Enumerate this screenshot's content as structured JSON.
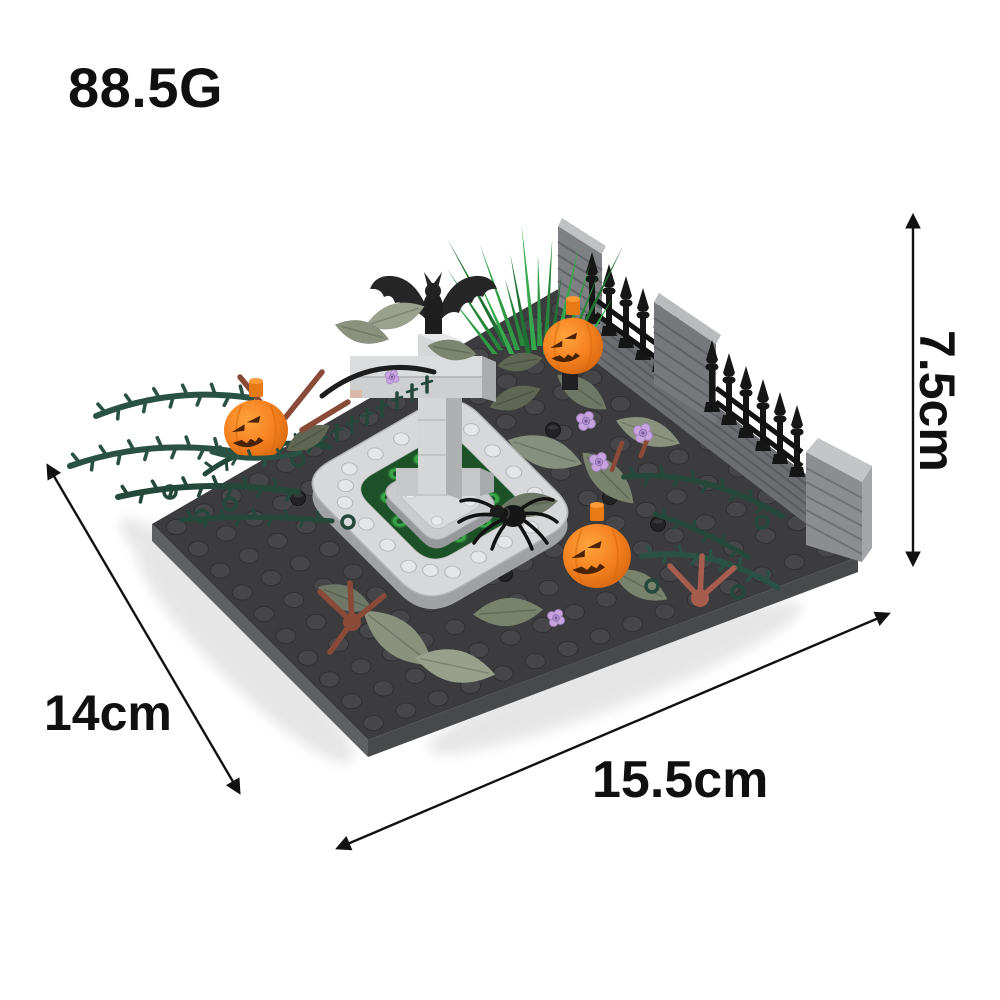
{
  "product_photo": {
    "weight_label": "88.5G",
    "dimensions": {
      "height": "7.5cm",
      "depth": "14cm",
      "width": "15.5cm"
    }
  },
  "colors": {
    "annotation_text": "#101010",
    "arrow": "#111111",
    "background": "#ffffff",
    "pumpkin_orange": "#f58220",
    "baseplate_gray": "#3c3c3e",
    "fountain_gray": "#d6d8d9",
    "grass_green": "#2f9c45",
    "vine_green": "#2a5244",
    "leaf_olive": "#87907e",
    "flower_lavender": "#c7a4de",
    "wall_gray": "#7e8083",
    "fence_black": "#161616",
    "twig_brown": "#8a4a38",
    "water_green": "#1d5128"
  },
  "scene_parts": [
    "baseplate",
    "stone wall",
    "spiked fence",
    "grass tuft",
    "fountain",
    "cross tombstone",
    "bat",
    "jack-o-lantern pumpkins",
    "spider",
    "thorn vines",
    "leaves",
    "lavender flowers",
    "twigs"
  ]
}
